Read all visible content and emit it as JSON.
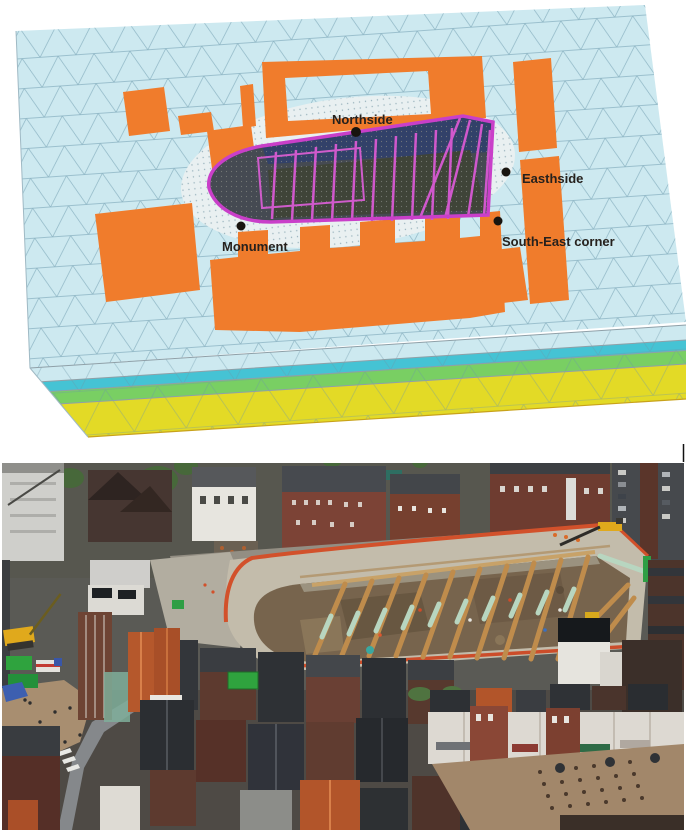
{
  "mesh_figure": {
    "labels": {
      "northside": "Northside",
      "easthside": "Easthside",
      "monument": "Monument",
      "south_east_corner": "South-East corner"
    },
    "palette": {
      "ground_surface": "#cde9f0",
      "mesh_line": "#7fa9ba",
      "building_footprints": "#f07c2c",
      "excavation_outline": "#c93fc9",
      "excavation_struts": "#d058cc",
      "pit_interior": "#454a52",
      "pit_north_wall": "#31406b",
      "soil_layer_teal": "#45c3d4",
      "soil_layer_green": "#79cf63",
      "soil_layer_yellow": "#e3da26"
    }
  },
  "photo_figure": {
    "palette": {
      "pit_floor": "#77644d",
      "pit_wall": "#c3bcab",
      "safety_barrier_orange": "#d2512b",
      "timber_strut": "#bf8c4c",
      "strut_sleeve_green": "#b8d6c0",
      "brick_building": "#7c4336",
      "dark_roof": "#33363a",
      "tiled_roof_orange": "#b2552a",
      "white_facade": "#e6e4de",
      "street": "#8e9192",
      "plaza": "#a88e70",
      "tree": "#47683a",
      "crane_yellow": "#e0a91c",
      "site_cabin_green": "#2fa33e"
    }
  }
}
